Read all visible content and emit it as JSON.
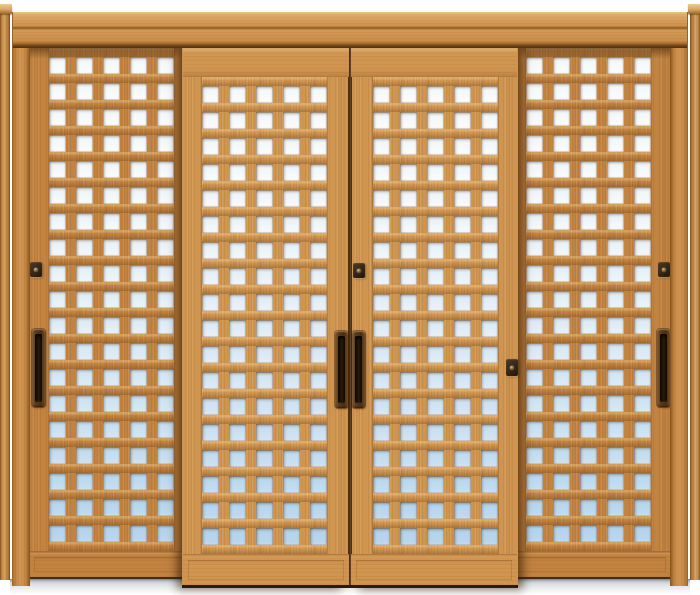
{
  "meta": {
    "description": "Product photograph of a four-panel wooden lattice sliding door set (shoji style) with square glass openings, wood surround frame, dark recessed pulls and latch locks, gray floor sill. No text in image.",
    "background": "#ffffff",
    "width": 700,
    "height": 595
  },
  "colors": {
    "wood_front": "#d09550",
    "wood_rear": "#c28340",
    "glass_top": "#fbfcfc",
    "glass_bottom": "#b2d3ec",
    "hardware_dark": "#2a1a09",
    "sill_gray": "#d6d9da"
  },
  "grid": {
    "cols": 5,
    "square": 17,
    "col_pitch": 27,
    "row_pitch": 26,
    "glass_ref_top": 57,
    "glass_ref_span": 470
  },
  "frame": {
    "post_left": {
      "x": 0,
      "y": 8,
      "w": 10,
      "h": 572
    },
    "post_cap_left": {
      "x": 0,
      "y": 4,
      "w": 12,
      "h": 10
    },
    "post_right": {
      "x": 690,
      "y": 8,
      "w": 10,
      "h": 572
    },
    "post_cap_right": {
      "x": 688,
      "y": 4,
      "w": 12,
      "h": 10
    },
    "head_beam": {
      "x": 12,
      "y": 12,
      "w": 676,
      "h": 36
    },
    "jamb_left": {
      "x": 12,
      "y": 46,
      "w": 18,
      "h": 540
    },
    "jamb_right": {
      "x": 670,
      "y": 46,
      "w": 18,
      "h": 540
    },
    "sill": {
      "x": 10,
      "y": 579,
      "w": 680,
      "h": 15
    }
  },
  "panels": [
    {
      "name": "door-panel-1",
      "layer": "rear",
      "x": 28,
      "w": 166,
      "top": 48,
      "bottom": 579,
      "glass_col_start": 49,
      "glass_row_start": 57,
      "rows": 19,
      "shadow": null,
      "seam": null,
      "hardware": [
        {
          "type": "lock",
          "x": 30,
          "y": 262,
          "w": 12,
          "h": 15
        },
        {
          "type": "handle",
          "x": 32,
          "y": 329,
          "w": 13,
          "h": 78
        }
      ]
    },
    {
      "name": "door-panel-2",
      "layer": "front",
      "x": 182,
      "w": 168,
      "top": 45,
      "bottom": 588,
      "glass_col_start": 202,
      "glass_row_start": 85,
      "rows": 18,
      "shadow": "left",
      "seam": "right",
      "hardware": [
        {
          "type": "handle",
          "x": 335,
          "y": 330,
          "w": 13,
          "h": 77
        }
      ]
    },
    {
      "name": "door-panel-3",
      "layer": "front",
      "x": 350,
      "w": 168,
      "top": 45,
      "bottom": 588,
      "glass_col_start": 373,
      "glass_row_start": 85,
      "rows": 18,
      "shadow": "right",
      "seam": "left",
      "hardware": [
        {
          "type": "lock",
          "x": 353,
          "y": 262,
          "w": 12,
          "h": 15
        },
        {
          "type": "handle",
          "x": 352,
          "y": 330,
          "w": 13,
          "h": 77
        },
        {
          "type": "lock",
          "x": 506,
          "y": 358,
          "w": 12,
          "h": 17
        }
      ]
    },
    {
      "name": "door-panel-4",
      "layer": "rear",
      "x": 506,
      "w": 166,
      "top": 48,
      "bottom": 579,
      "glass_col_start": 526,
      "glass_row_start": 57,
      "rows": 19,
      "shadow": null,
      "seam": null,
      "hardware": [
        {
          "type": "lock",
          "x": 658,
          "y": 262,
          "w": 12,
          "h": 15
        },
        {
          "type": "handle",
          "x": 657,
          "y": 329,
          "w": 13,
          "h": 78
        }
      ]
    }
  ]
}
